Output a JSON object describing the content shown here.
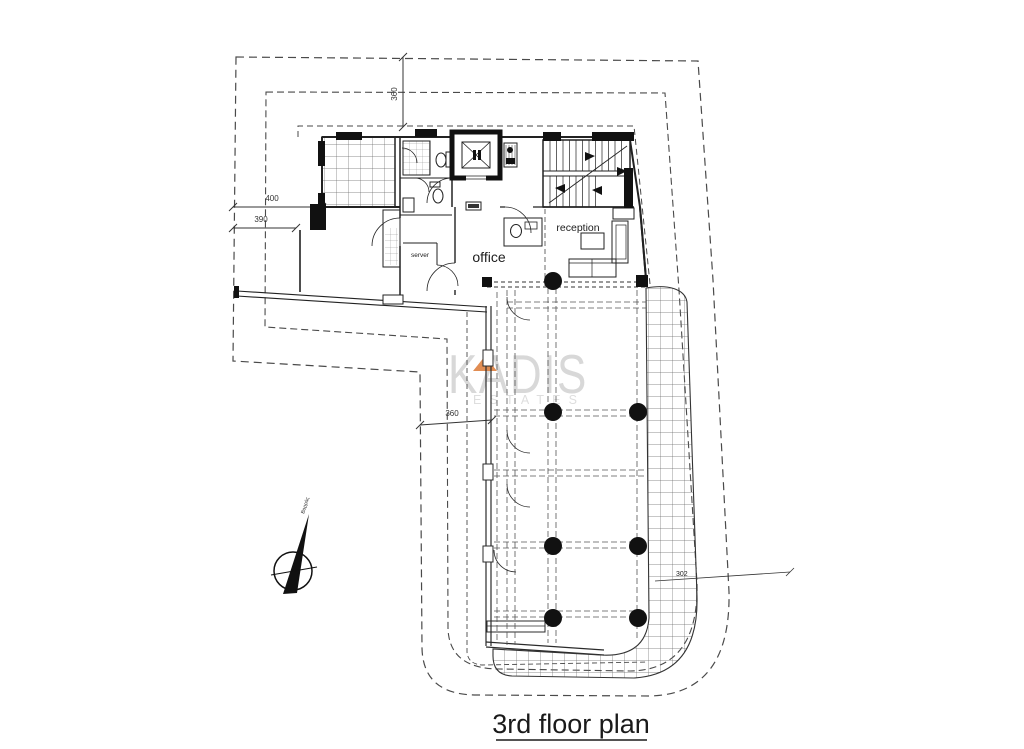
{
  "title": {
    "label": "3rd floor plan"
  },
  "watermark": {
    "name": "KADIS",
    "tagline": "ESTATES"
  },
  "rooms": {
    "office_label": "office",
    "reception_label": "reception",
    "server_label": "server"
  },
  "dimensions": {
    "top_offset": "360",
    "left_offset_upper": "400",
    "left_offset_lower": "390",
    "mid_offset": "360",
    "unit_number": "302"
  },
  "north": {
    "label": "Βορράς"
  },
  "colors": {
    "line": "#2b2b2b",
    "boundary": "#4a4a4a",
    "watermark_gray": "#d8d8d8",
    "accent_orange": "#de8140",
    "column_black": "#111111"
  }
}
